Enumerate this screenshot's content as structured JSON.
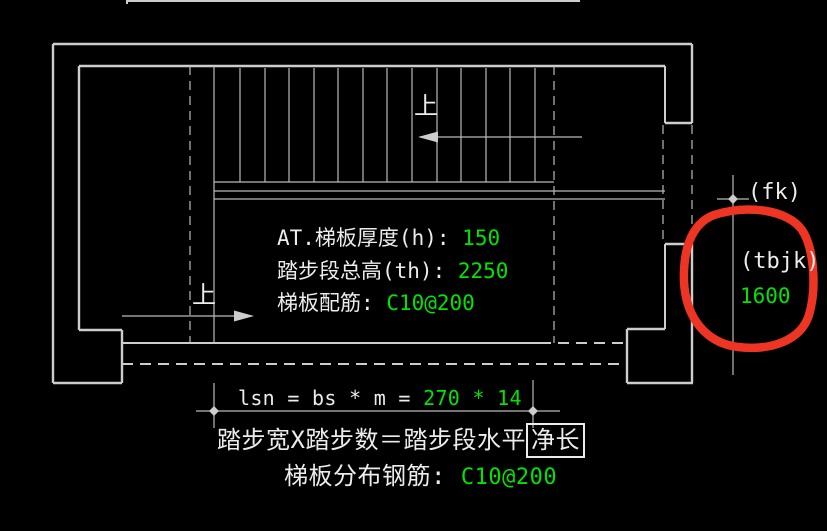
{
  "colors": {
    "background": "#000000",
    "line_gray": "#cdcdcd",
    "thin_gray": "#b9b9b9",
    "text_white": "#ececec",
    "text_green": "#00e400",
    "annotation_red": "#ee3524"
  },
  "drawing": {
    "up_arrow_top_label": "上",
    "up_arrow_bottom_label": "上",
    "info_panel": {
      "rows": [
        {
          "label": "AT.梯板厚度(h):",
          "value": "150"
        },
        {
          "label": "踏步段总高(th):",
          "value": "2250"
        },
        {
          "label": "梯板配筋:",
          "value": "C10@200"
        }
      ]
    },
    "bottom_annotations": {
      "formula_label": "lsn = bs * m =",
      "formula_value": "270 * 14",
      "caption_prefix": "踏步宽X踏步数＝踏步段水平",
      "caption_boxed": "净长",
      "rebar_label": "梯板分布钢筋:",
      "rebar_value": "C10@200"
    },
    "right_dimension": {
      "fk_label": "(fk)",
      "tbjk_label": "(tbjk)",
      "tbjk_value": "1600"
    }
  }
}
